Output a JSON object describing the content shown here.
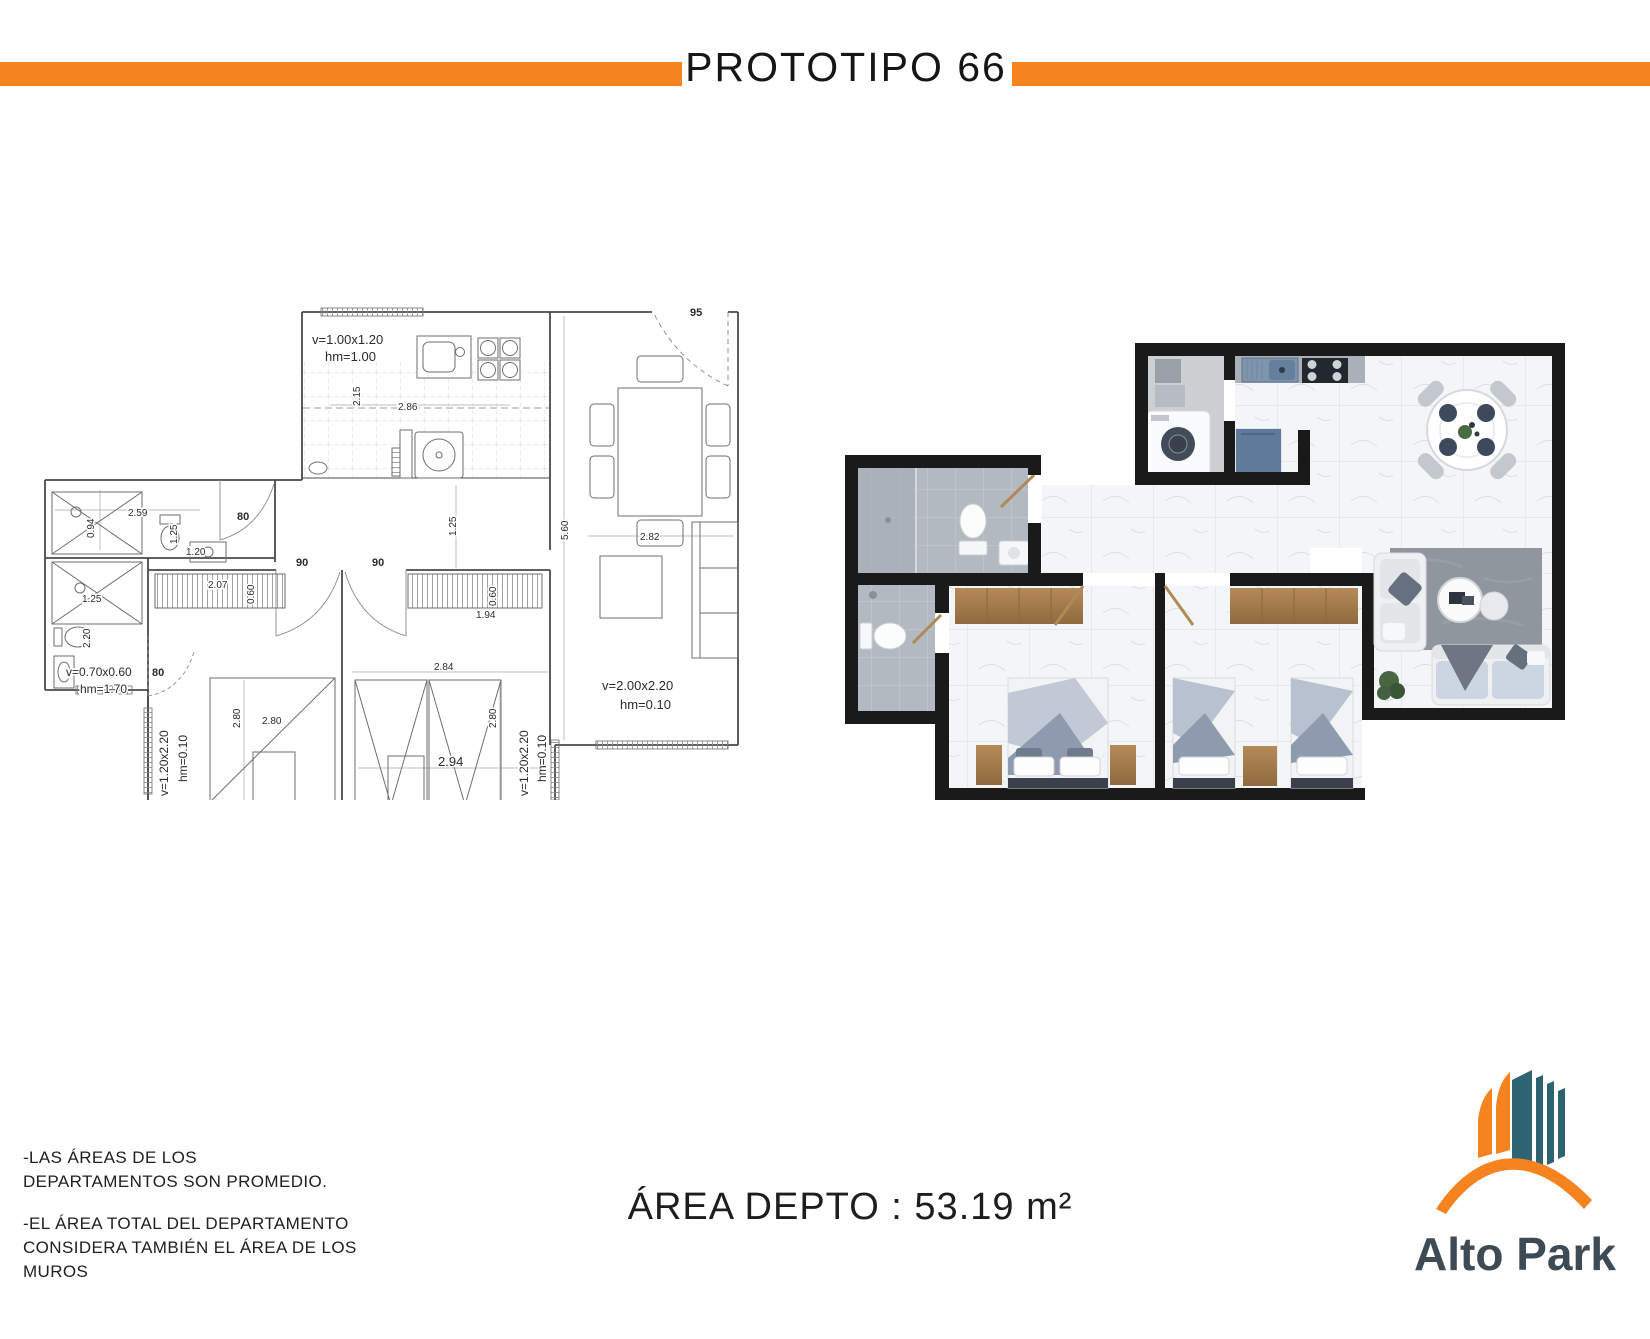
{
  "header": {
    "title": "PROTOTIPO 66"
  },
  "colors": {
    "accent_orange": "#F5831F",
    "logo_teal": "#2E6472",
    "logo_slate": "#3E4A54",
    "render_wall_black": "#1a1a1a"
  },
  "blueprint": {
    "labels": [
      {
        "t": "v=1.00x1.20",
        "x": 272,
        "y": 44,
        "s": 13
      },
      {
        "t": "hm=1.00",
        "x": 285,
        "y": 61,
        "s": 13
      },
      {
        "t": "2.15",
        "x": 320,
        "y": 106,
        "s": 10,
        "r": -90
      },
      {
        "t": "2.86",
        "x": 358,
        "y": 110,
        "s": 10
      },
      {
        "t": "95",
        "x": 650,
        "y": 16,
        "s": 11,
        "b": 1
      },
      {
        "t": "5.60",
        "x": 528,
        "y": 240,
        "s": 10,
        "r": -90
      },
      {
        "t": "2.82",
        "x": 600,
        "y": 240,
        "s": 10
      },
      {
        "t": "2.59",
        "x": 88,
        "y": 216,
        "s": 10
      },
      {
        "t": "0.94",
        "x": 54,
        "y": 238,
        "s": 10,
        "r": -90
      },
      {
        "t": "1.25",
        "x": 137,
        "y": 244,
        "s": 10,
        "r": -90
      },
      {
        "t": "1.20",
        "x": 146,
        "y": 255,
        "s": 10
      },
      {
        "t": "80",
        "x": 197,
        "y": 220,
        "s": 11,
        "b": 1
      },
      {
        "t": "1.25",
        "x": 42,
        "y": 302,
        "s": 10
      },
      {
        "t": "2.20",
        "x": 50,
        "y": 348,
        "s": 10,
        "r": -90
      },
      {
        "t": "v=0.70x0.60",
        "x": 26,
        "y": 376,
        "s": 12
      },
      {
        "t": "hm=1.70",
        "x": 40,
        "y": 393,
        "s": 12
      },
      {
        "t": "80",
        "x": 112,
        "y": 376,
        "s": 11,
        "b": 1
      },
      {
        "t": "2.07",
        "x": 168,
        "y": 288,
        "s": 10
      },
      {
        "t": "0.60",
        "x": 214,
        "y": 304,
        "s": 10,
        "r": -90
      },
      {
        "t": "90",
        "x": 256,
        "y": 266,
        "s": 11,
        "b": 1
      },
      {
        "t": "90",
        "x": 332,
        "y": 266,
        "s": 11,
        "b": 1
      },
      {
        "t": "1.25",
        "x": 416,
        "y": 236,
        "s": 10,
        "r": -90
      },
      {
        "t": "1.94",
        "x": 436,
        "y": 318,
        "s": 10
      },
      {
        "t": "0.60",
        "x": 456,
        "y": 306,
        "s": 10,
        "r": -90
      },
      {
        "t": "2.84",
        "x": 394,
        "y": 370,
        "s": 10
      },
      {
        "t": "2.80",
        "x": 200,
        "y": 428,
        "s": 10,
        "r": -90
      },
      {
        "t": "2.80",
        "x": 222,
        "y": 424,
        "s": 10
      },
      {
        "t": "2.80",
        "x": 456,
        "y": 428,
        "s": 10,
        "r": -90
      },
      {
        "t": "2.94",
        "x": 398,
        "y": 466,
        "s": 13
      },
      {
        "t": "v=1.20x2.20",
        "x": 128,
        "y": 496,
        "s": 12,
        "r": -90
      },
      {
        "t": "hm=0.10",
        "x": 147,
        "y": 482,
        "s": 12,
        "r": -90
      },
      {
        "t": "v=1.20x2.20",
        "x": 488,
        "y": 496,
        "s": 12,
        "r": -90
      },
      {
        "t": "hm=0.10",
        "x": 506,
        "y": 482,
        "s": 12,
        "r": -90
      },
      {
        "t": "v=2.00x2.20",
        "x": 562,
        "y": 390,
        "s": 13
      },
      {
        "t": "hm=0.10",
        "x": 580,
        "y": 409,
        "s": 13
      }
    ]
  },
  "notes": {
    "line1": "-LAS ÁREAS DE LOS",
    "line2": "DEPARTAMENTOS SON PROMEDIO.",
    "line3": "-EL ÁREA TOTAL DEL DEPARTAMENTO",
    "line4": "CONSIDERA TAMBIÉN EL ÁREA DE LOS",
    "line5": "MUROS"
  },
  "area": {
    "text": "ÁREA DEPTO : 53.19 m²"
  },
  "logo": {
    "text": "Alto Park",
    "icon": "building-skyline-icon"
  }
}
